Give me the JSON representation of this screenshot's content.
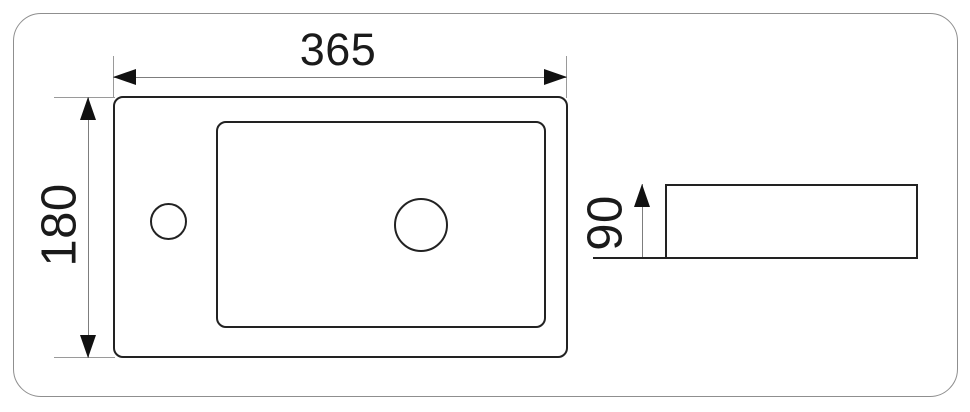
{
  "dimensions": {
    "top_view": {
      "width": "365",
      "height": "180"
    },
    "side_view": {
      "height": "90"
    }
  },
  "colors": {
    "outline": "#222222",
    "dimension_line": "#7d7d7d",
    "extension_line": "#9a9a9a",
    "arrowhead": "#111111",
    "frame_border": "#8f8f8f",
    "text": "#1a1a1a",
    "background": "#ffffff"
  }
}
